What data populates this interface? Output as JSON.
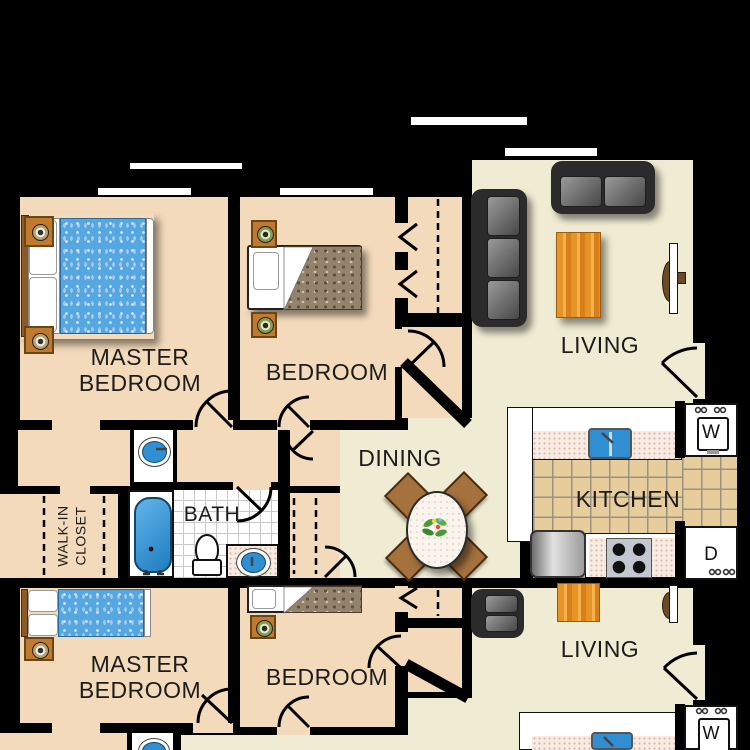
{
  "title": "Apartment floor plan, two stacked units",
  "colors": {
    "background": "#000000",
    "bedroom_floor": "#f3dabb",
    "living_floor": "#f0ecd3",
    "kitchen_tile": "#e7cd9c",
    "counter_speckle": "#f7ebe2",
    "water_blue": "#2f8fd2",
    "comforter_blue": "#55a7e2",
    "comforter_brown": "#93826c",
    "sofa_gray": "#2b2b2b",
    "wood_orange": "#e79427",
    "chair_brown": "#a5713d",
    "window_white": "#ffffff"
  },
  "unit_top": {
    "master_bedroom": {
      "line1": "MASTER",
      "line2": "BEDROOM"
    },
    "bedroom": "BEDROOM",
    "living": "LIVING",
    "dining": "DINING",
    "kitchen": "KITCHEN",
    "bath": "BATH",
    "walk_in_closet": {
      "line1": "WALK-IN",
      "line2": "CLOSET"
    },
    "washer": "W",
    "dryer": "D"
  },
  "unit_bottom": {
    "master_bedroom": {
      "line1": "MASTER",
      "line2": "BEDROOM"
    },
    "bedroom": "BEDROOM",
    "living": "LIVING",
    "washer": "W"
  }
}
